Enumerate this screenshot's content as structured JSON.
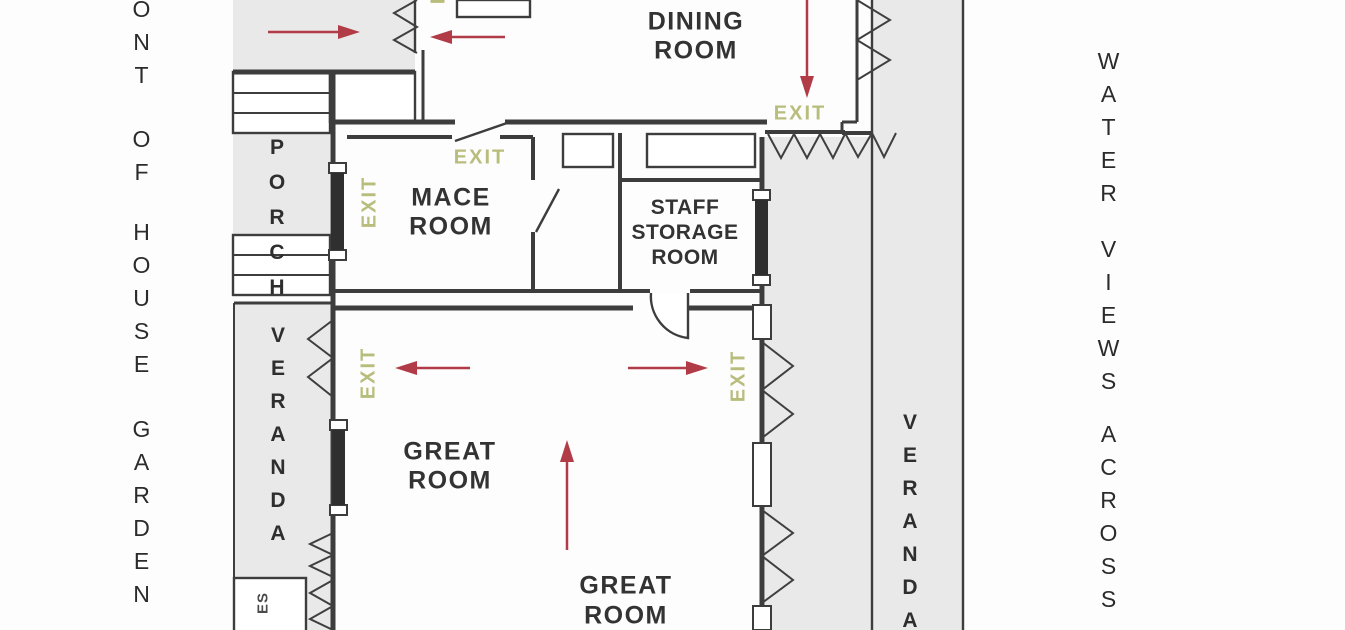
{
  "labels": {
    "exit": "EXIT",
    "dining_room": [
      "DINING",
      "ROOM"
    ],
    "mace_room": [
      "MACE",
      "ROOM"
    ],
    "staff_storage_room": [
      "STAFF",
      "STORAGE",
      "ROOM"
    ],
    "great_room_upper": [
      "GREAT",
      "ROOM"
    ],
    "great_room_lower": [
      "GREAT",
      "ROOM"
    ],
    "porch": "PORCH",
    "veranda_left": "VERANDA",
    "veranda_right": "VERANDA",
    "toilets_partial": "ES"
  },
  "margin_text": {
    "left_words": [
      "ONT",
      "OF",
      "HOUSE",
      "GARDEN"
    ],
    "right_words": [
      "WATER",
      "VIEWS",
      "ACROSS"
    ]
  },
  "colors": {
    "exit_green": "#b9bd7c",
    "arrow_red": "#b23b48",
    "wall_dark": "#3d3d3d",
    "area_gray": "#e9e9e9",
    "label_text": "#333333"
  }
}
